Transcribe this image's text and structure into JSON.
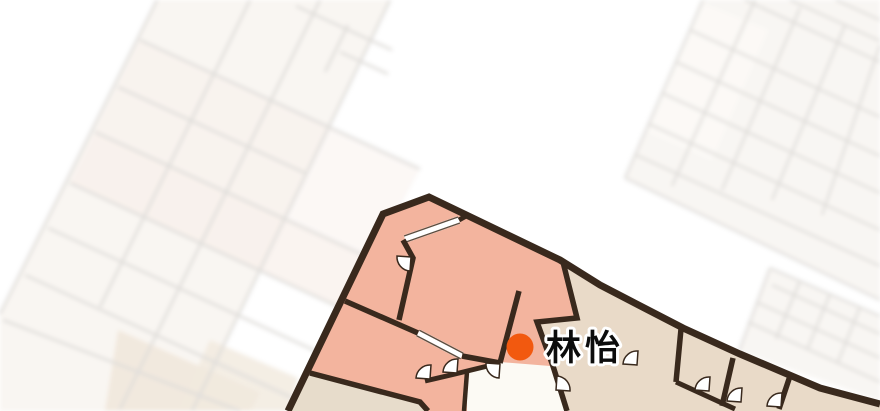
{
  "map": {
    "marker": {
      "label": "林怡",
      "dot_color": "#f2590f"
    },
    "colors": {
      "selected_unit_fill": "#f3b49e",
      "neighbor_room_fill": "#e9dac8",
      "bottom_left_room_fill": "#e7dccb",
      "corridor_fill": "#fcfaf4",
      "wall": "#39291d",
      "window_frame": "#5d4c3e",
      "door_fill": "#ffffff",
      "bg_left_building_fill": "#f8f4ef",
      "bg_right_building_fill": "#f7f4f0",
      "bg_room_pink": "#f7ece5",
      "bg_room_tan": "#eee3d5",
      "bg_room_light": "#fbf8f4",
      "bg_line": "#d8d5d1"
    }
  }
}
